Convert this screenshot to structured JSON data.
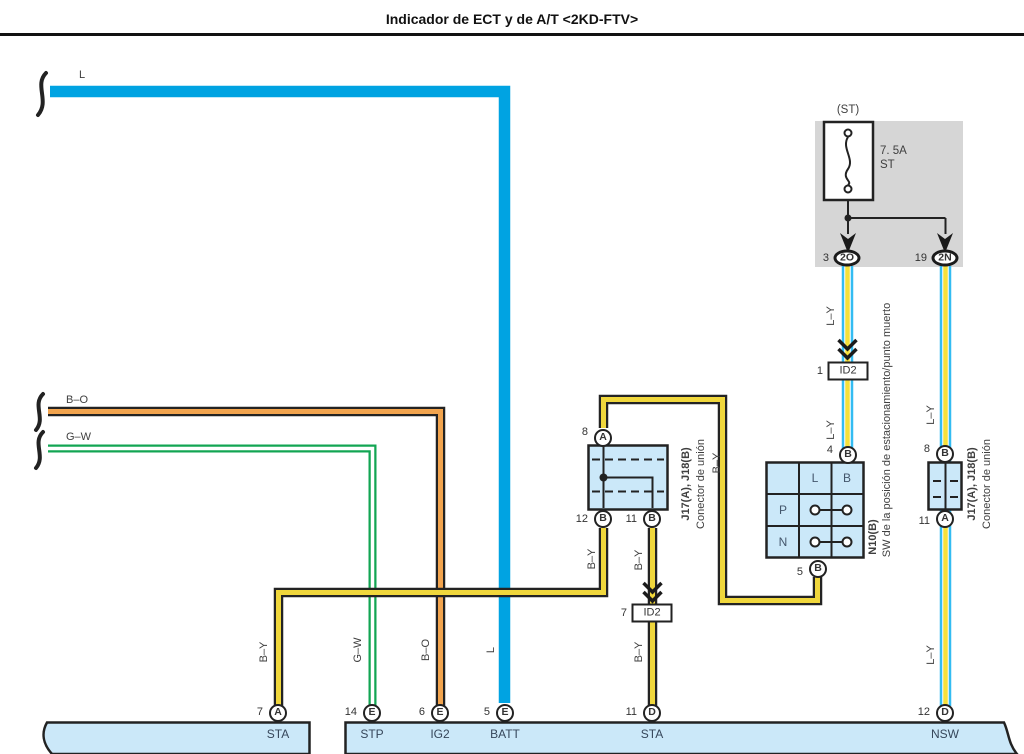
{
  "title": "Indicador de ECT y de A/T <2KD-FTV>",
  "wire_tags": {
    "ly": "L–Y",
    "by": "B–Y",
    "gw": "G–W",
    "bo": "B–O",
    "l": "L"
  },
  "fuse": {
    "title": "(ST)",
    "rating": "7. 5A",
    "name": "ST"
  },
  "fuse_outputs": [
    {
      "pin": "3",
      "socket": "2O"
    },
    {
      "pin": "19",
      "socket": "2N"
    }
  ],
  "id_connectors": [
    {
      "pin": "1",
      "label": "ID2"
    },
    {
      "pin": "7",
      "label": "ID2"
    }
  ],
  "junction_mid": {
    "name": "J17(A), J18(B)",
    "desc": "Conector de unión",
    "pin_top": {
      "num": "8",
      "letter": "A"
    },
    "pin_bl": {
      "num": "12",
      "letter": "B"
    },
    "pin_br": {
      "num": "11",
      "letter": "B"
    }
  },
  "junction_right": {
    "name": "J17(A), J18(B)",
    "desc": "Conector de unión",
    "pin_top": {
      "num": "8",
      "letter": "B"
    },
    "pin_bottom": {
      "num": "11",
      "letter": "A"
    }
  },
  "n10": {
    "name": "N10(B)",
    "desc": "SW de la posición de estacionamiento/punto muerto",
    "col_l": "L",
    "col_b": "B",
    "row_p": "P",
    "row_n": "N",
    "pin_top": {
      "num": "4",
      "letter": "B"
    },
    "pin_bottom": {
      "num": "5",
      "letter": "B"
    }
  },
  "bottom_terminals": [
    {
      "pin": "7",
      "letter": "A",
      "signal": "STA"
    },
    {
      "pin": "14",
      "letter": "E",
      "signal": "STP"
    },
    {
      "pin": "6",
      "letter": "E",
      "signal": "IG2"
    },
    {
      "pin": "5",
      "letter": "E",
      "signal": "BATT"
    },
    {
      "pin": "11",
      "letter": "D",
      "signal": "STA"
    },
    {
      "pin": "12",
      "letter": "D",
      "signal": "NSW"
    }
  ],
  "colors": {
    "blue": "#00A3E2",
    "cyan": "#33BCF2",
    "yellow": "#F0D73C",
    "orange": "#F2A44E",
    "green": "#12A553",
    "lightblue": "#CBE8F9",
    "gray": "#D6D6D6",
    "line": "#232323",
    "text": "#3F3F3F"
  }
}
